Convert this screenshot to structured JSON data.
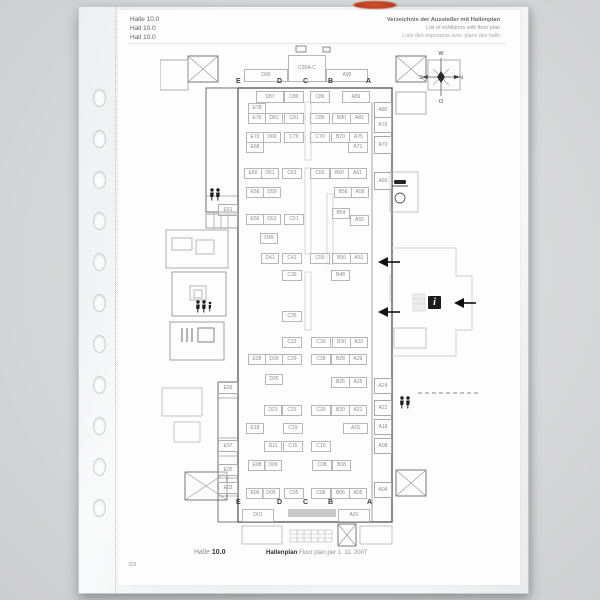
{
  "header": {
    "left_lines": [
      "Halle 10.0",
      "Hall 10.0",
      "Hall 10.0"
    ],
    "right_lines": [
      "Verzeichnis der Aussteller mit Hallenplan",
      "List of exhibitors with floor plan",
      "Liste des exposants avec plans des halls"
    ]
  },
  "compass": {
    "top": "W",
    "left": "S",
    "right": "N",
    "bottom": "O"
  },
  "footer": {
    "hall_label": "Halle",
    "hall_number": "10.0",
    "plan_label": "Hallenplan",
    "plan_date": "Floor plan per 1. 11. 2007",
    "page_number": "329"
  },
  "plan": {
    "letters_top": [
      {
        "t": "E",
        "x": 76
      },
      {
        "t": "D",
        "x": 117
      },
      {
        "t": "C",
        "x": 143
      },
      {
        "t": "B",
        "x": 168
      },
      {
        "t": "A",
        "x": 206
      }
    ],
    "letters_bottom": [
      {
        "t": "E",
        "x": 76
      },
      {
        "t": "D",
        "x": 117
      },
      {
        "t": "C",
        "x": 143
      },
      {
        "t": "B",
        "x": 168
      },
      {
        "t": "A",
        "x": 207
      }
    ],
    "letters_top_y": 34,
    "letters_bottom_y": 455,
    "booths": [
      {
        "l": "D90",
        "x": 84,
        "y": 25,
        "w": 42,
        "h": 11
      },
      {
        "l": "C90A-C",
        "x": 128,
        "y": 11,
        "w": 36,
        "h": 25
      },
      {
        "l": "A90",
        "x": 166,
        "y": 25,
        "w": 40,
        "h": 11
      },
      {
        "l": "D87",
        "x": 96,
        "y": 47,
        "w": 26,
        "h": 10
      },
      {
        "l": "C89",
        "x": 124,
        "y": 47,
        "w": 18,
        "h": 10
      },
      {
        "l": "C86",
        "x": 150,
        "y": 47,
        "w": 18,
        "h": 10
      },
      {
        "l": "A89",
        "x": 182,
        "y": 47,
        "w": 26,
        "h": 10
      },
      {
        "l": "E78",
        "x": 88,
        "y": 59,
        "w": 16,
        "h": 9
      },
      {
        "l": "E76",
        "x": 88,
        "y": 69,
        "w": 16,
        "h": 9
      },
      {
        "l": "D81",
        "x": 105,
        "y": 69,
        "w": 16,
        "h": 9
      },
      {
        "l": "C81",
        "x": 124,
        "y": 69,
        "w": 18,
        "h": 9
      },
      {
        "l": "C80",
        "x": 150,
        "y": 69,
        "w": 18,
        "h": 9
      },
      {
        "l": "B80",
        "x": 172,
        "y": 69,
        "w": 17,
        "h": 9
      },
      {
        "l": "A81",
        "x": 190,
        "y": 69,
        "w": 17,
        "h": 9
      },
      {
        "l": "E70",
        "x": 86,
        "y": 88,
        "w": 16,
        "h": 9
      },
      {
        "l": "D69",
        "x": 103,
        "y": 88,
        "w": 16,
        "h": 9
      },
      {
        "l": "C79",
        "x": 124,
        "y": 88,
        "w": 18,
        "h": 9
      },
      {
        "l": "C70",
        "x": 150,
        "y": 88,
        "w": 18,
        "h": 9
      },
      {
        "l": "B70",
        "x": 171,
        "y": 88,
        "w": 17,
        "h": 9
      },
      {
        "l": "A75",
        "x": 189,
        "y": 88,
        "w": 17,
        "h": 9
      },
      {
        "l": "E68",
        "x": 86,
        "y": 98,
        "w": 16,
        "h": 9
      },
      {
        "l": "A71",
        "x": 188,
        "y": 98,
        "w": 18,
        "h": 9
      },
      {
        "l": "E60",
        "x": 84,
        "y": 124,
        "w": 16,
        "h": 9
      },
      {
        "l": "D61",
        "x": 101,
        "y": 124,
        "w": 16,
        "h": 9
      },
      {
        "l": "C61",
        "x": 122,
        "y": 124,
        "w": 18,
        "h": 9
      },
      {
        "l": "C60",
        "x": 150,
        "y": 124,
        "w": 18,
        "h": 9
      },
      {
        "l": "B60",
        "x": 170,
        "y": 124,
        "w": 17,
        "h": 9
      },
      {
        "l": "A61",
        "x": 188,
        "y": 124,
        "w": 17,
        "h": 9
      },
      {
        "l": "E58",
        "x": 86,
        "y": 143,
        "w": 16,
        "h": 9
      },
      {
        "l": "D59",
        "x": 103,
        "y": 143,
        "w": 16,
        "h": 9
      },
      {
        "l": "B58",
        "x": 174,
        "y": 143,
        "w": 16,
        "h": 9
      },
      {
        "l": "A58",
        "x": 191,
        "y": 143,
        "w": 16,
        "h": 9
      },
      {
        "l": "B54",
        "x": 172,
        "y": 164,
        "w": 16,
        "h": 9
      },
      {
        "l": "E50",
        "x": 86,
        "y": 170,
        "w": 16,
        "h": 9
      },
      {
        "l": "D51",
        "x": 103,
        "y": 170,
        "w": 16,
        "h": 9
      },
      {
        "l": "C51",
        "x": 124,
        "y": 170,
        "w": 18,
        "h": 9
      },
      {
        "l": "A55",
        "x": 190,
        "y": 171,
        "w": 17,
        "h": 9
      },
      {
        "l": "D49",
        "x": 100,
        "y": 189,
        "w": 16,
        "h": 9
      },
      {
        "l": "D41",
        "x": 101,
        "y": 209,
        "w": 16,
        "h": 9
      },
      {
        "l": "C41",
        "x": 122,
        "y": 209,
        "w": 18,
        "h": 9
      },
      {
        "l": "C50",
        "x": 150,
        "y": 209,
        "w": 18,
        "h": 9
      },
      {
        "l": "B50",
        "x": 172,
        "y": 209,
        "w": 17,
        "h": 9
      },
      {
        "l": "A51",
        "x": 190,
        "y": 209,
        "w": 16,
        "h": 9
      },
      {
        "l": "C39",
        "x": 122,
        "y": 226,
        "w": 18,
        "h": 9
      },
      {
        "l": "B48",
        "x": 171,
        "y": 226,
        "w": 17,
        "h": 9
      },
      {
        "l": "C35",
        "x": 122,
        "y": 267,
        "w": 18,
        "h": 9
      },
      {
        "l": "C31",
        "x": 122,
        "y": 293,
        "w": 18,
        "h": 9
      },
      {
        "l": "C30",
        "x": 151,
        "y": 293,
        "w": 18,
        "h": 9
      },
      {
        "l": "B30",
        "x": 172,
        "y": 293,
        "w": 17,
        "h": 9
      },
      {
        "l": "A31",
        "x": 190,
        "y": 293,
        "w": 16,
        "h": 9
      },
      {
        "l": "E28",
        "x": 88,
        "y": 310,
        "w": 16,
        "h": 9
      },
      {
        "l": "D29",
        "x": 105,
        "y": 310,
        "w": 16,
        "h": 9
      },
      {
        "l": "C29",
        "x": 122,
        "y": 310,
        "w": 18,
        "h": 9
      },
      {
        "l": "C28",
        "x": 151,
        "y": 310,
        "w": 18,
        "h": 9
      },
      {
        "l": "B28",
        "x": 171,
        "y": 310,
        "w": 17,
        "h": 9
      },
      {
        "l": "A29",
        "x": 189,
        "y": 310,
        "w": 16,
        "h": 9
      },
      {
        "l": "D25",
        "x": 105,
        "y": 330,
        "w": 16,
        "h": 9
      },
      {
        "l": "B26",
        "x": 171,
        "y": 333,
        "w": 17,
        "h": 9
      },
      {
        "l": "A25",
        "x": 189,
        "y": 333,
        "w": 16,
        "h": 9
      },
      {
        "l": "D21",
        "x": 104,
        "y": 361,
        "w": 16,
        "h": 9
      },
      {
        "l": "C21",
        "x": 122,
        "y": 361,
        "w": 18,
        "h": 9
      },
      {
        "l": "C20",
        "x": 151,
        "y": 361,
        "w": 18,
        "h": 9
      },
      {
        "l": "B20",
        "x": 171,
        "y": 361,
        "w": 17,
        "h": 9
      },
      {
        "l": "A21",
        "x": 189,
        "y": 361,
        "w": 16,
        "h": 9
      },
      {
        "l": "E18",
        "x": 86,
        "y": 379,
        "w": 16,
        "h": 9
      },
      {
        "l": "C19",
        "x": 123,
        "y": 379,
        "w": 18,
        "h": 9
      },
      {
        "l": "A15",
        "x": 183,
        "y": 379,
        "w": 23,
        "h": 9
      },
      {
        "l": "D11",
        "x": 104,
        "y": 397,
        "w": 16,
        "h": 9
      },
      {
        "l": "C15",
        "x": 123,
        "y": 397,
        "w": 18,
        "h": 9
      },
      {
        "l": "C10",
        "x": 151,
        "y": 397,
        "w": 18,
        "h": 9
      },
      {
        "l": "E08",
        "x": 88,
        "y": 416,
        "w": 16,
        "h": 9
      },
      {
        "l": "D09",
        "x": 104,
        "y": 416,
        "w": 16,
        "h": 9
      },
      {
        "l": "C08",
        "x": 152,
        "y": 416,
        "w": 18,
        "h": 9
      },
      {
        "l": "B08",
        "x": 172,
        "y": 416,
        "w": 17,
        "h": 9
      },
      {
        "l": "E06",
        "x": 86,
        "y": 444,
        "w": 16,
        "h": 9
      },
      {
        "l": "D05",
        "x": 102,
        "y": 444,
        "w": 16,
        "h": 9
      },
      {
        "l": "C05",
        "x": 124,
        "y": 444,
        "w": 18,
        "h": 9
      },
      {
        "l": "C06",
        "x": 151,
        "y": 444,
        "w": 18,
        "h": 9
      },
      {
        "l": "B06",
        "x": 171,
        "y": 444,
        "w": 17,
        "h": 9
      },
      {
        "l": "A05",
        "x": 189,
        "y": 444,
        "w": 16,
        "h": 9
      },
      {
        "l": "D01",
        "x": 82,
        "y": 465,
        "w": 30,
        "h": 11
      },
      {
        "l": "A01",
        "x": 178,
        "y": 465,
        "w": 30,
        "h": 11
      },
      {
        "l": "A80",
        "x": 214,
        "y": 58,
        "w": 16,
        "h": 14,
        "c": "r"
      },
      {
        "l": "A76",
        "x": 214,
        "y": 73,
        "w": 16,
        "h": 14,
        "c": "r"
      },
      {
        "l": "A70",
        "x": 214,
        "y": 92,
        "w": 16,
        "h": 16,
        "c": "r"
      },
      {
        "l": "A60",
        "x": 214,
        "y": 128,
        "w": 16,
        "h": 16,
        "c": "r"
      },
      {
        "l": "A24",
        "x": 214,
        "y": 334,
        "w": 16,
        "h": 14,
        "c": "r"
      },
      {
        "l": "A22",
        "x": 214,
        "y": 356,
        "w": 16,
        "h": 14,
        "c": "r"
      },
      {
        "l": "A18",
        "x": 214,
        "y": 375,
        "w": 16,
        "h": 14,
        "c": "r"
      },
      {
        "l": "A08",
        "x": 214,
        "y": 394,
        "w": 16,
        "h": 14,
        "c": "r"
      },
      {
        "l": "A04",
        "x": 214,
        "y": 438,
        "w": 16,
        "h": 14,
        "c": "r"
      },
      {
        "l": "E51",
        "x": 58,
        "y": 160,
        "w": 18,
        "h": 10,
        "c": "l"
      },
      {
        "l": "E09",
        "x": 58,
        "y": 338,
        "w": 18,
        "h": 10,
        "c": "l"
      },
      {
        "l": "E07",
        "x": 58,
        "y": 396,
        "w": 18,
        "h": 10,
        "c": "l"
      },
      {
        "l": "E05",
        "x": 58,
        "y": 420,
        "w": 18,
        "h": 10,
        "c": "l"
      },
      {
        "l": "E03",
        "x": 58,
        "y": 438,
        "w": 18,
        "h": 10,
        "c": "l"
      }
    ]
  }
}
